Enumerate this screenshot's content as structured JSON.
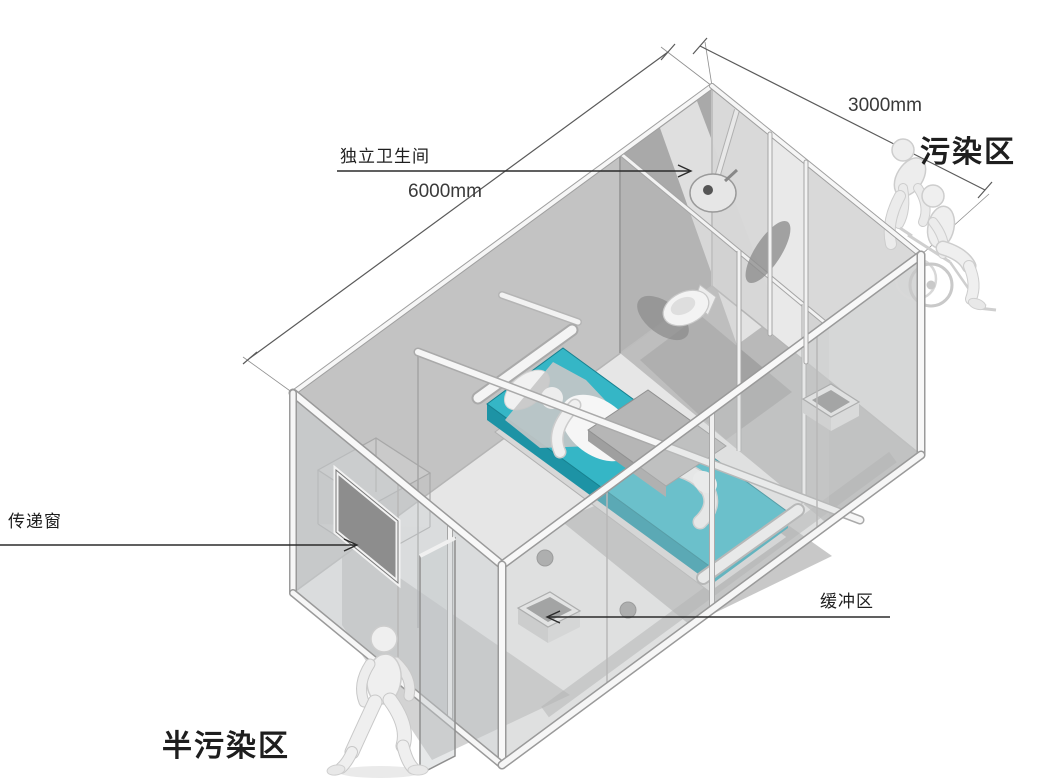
{
  "labels": {
    "bathroom": "独立卫生间",
    "length_dim": "6000mm",
    "width_dim": "3000mm",
    "contaminated_zone": "污染区",
    "transfer_window": "传递窗",
    "buffer_zone": "缓冲区",
    "semi_contaminated_zone": "半污染区"
  },
  "colors": {
    "background": "#ffffff",
    "bed_teal": "#35b6c6",
    "bed_teal_dark": "#1d93a5",
    "wall_gray": "#c3c3c3",
    "wall_dark_gray": "#a9a9a9",
    "shadow_gray": "#9a9a9a",
    "frame_white": "#f6f6f6",
    "line_dark": "#2b2b2b",
    "dimension_line": "#5a5a5a"
  },
  "scene": {
    "objects": [
      "container-ward",
      "independent-bathroom",
      "shower-head",
      "toilet",
      "hospital-bed",
      "patient-figure",
      "overbed-table",
      "transfer-window",
      "buffer-box",
      "sink-box",
      "entrance-glass-door",
      "walking-person-figure",
      "caregiver-figure",
      "wheelchair",
      "seated-patient-figure"
    ]
  }
}
